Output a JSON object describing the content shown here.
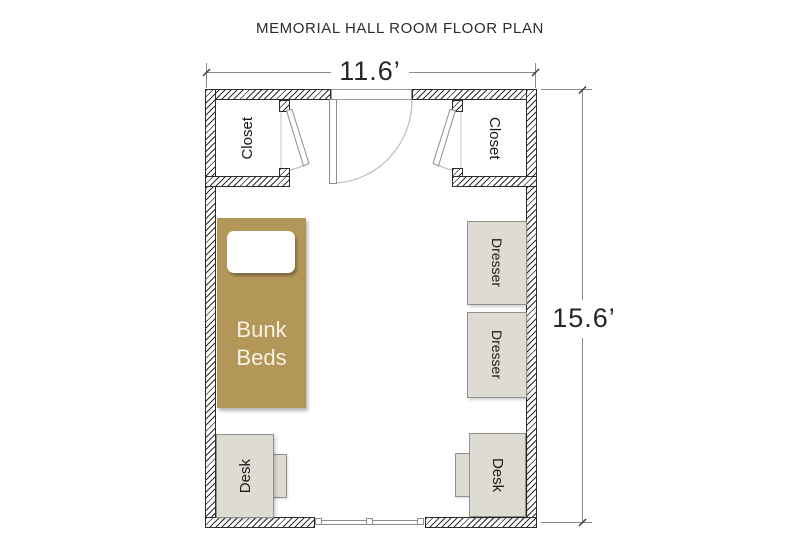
{
  "title": "MEMORIAL HALL ROOM FLOOR PLAN",
  "dimensions": {
    "width_label": "11.6’",
    "height_label": "15.6’"
  },
  "labels": {
    "closet_left": "Closet",
    "closet_right": "Closet",
    "bunk_beds": "Bunk Beds",
    "dresser_top": "Dresser",
    "dresser_bottom": "Dresser",
    "desk_left": "Desk",
    "desk_right": "Desk"
  },
  "colors": {
    "bed_fill": "#b29759",
    "bed_text": "#f7f2e3",
    "furniture_fill": "#dedbd2",
    "furniture_border": "#8f9089",
    "wall_hatch": "#2d2d2d",
    "dim_line": "#8b8b86",
    "text": "#2b2b2b"
  }
}
